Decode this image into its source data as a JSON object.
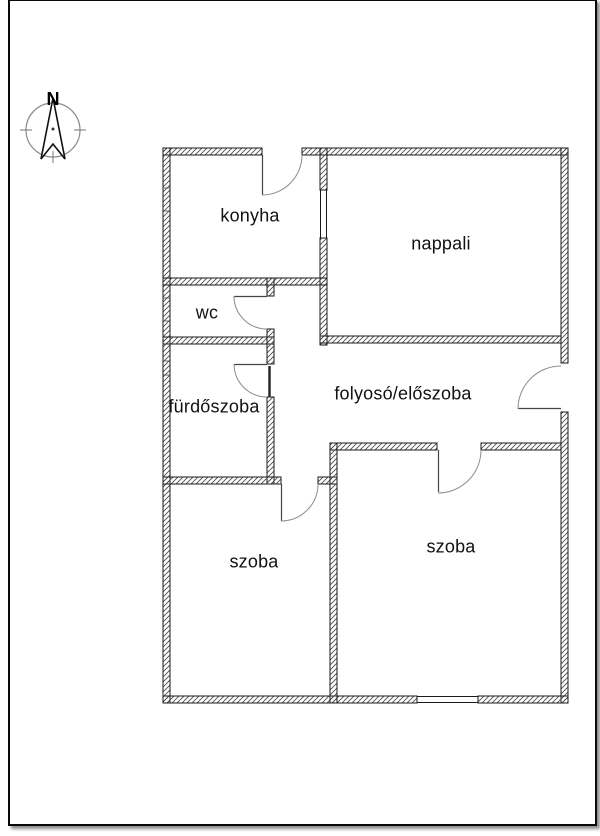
{
  "compass": {
    "north_label": "N"
  },
  "floor_plan": {
    "rooms": [
      {
        "id": "konyha",
        "label": "konyha"
      },
      {
        "id": "nappali",
        "label": "nappali"
      },
      {
        "id": "wc",
        "label": "wc"
      },
      {
        "id": "furdoszoba",
        "label": "fürdőszoba"
      },
      {
        "id": "folyoso",
        "label": "folyosó/előszoba"
      },
      {
        "id": "szoba-left",
        "label": "szoba"
      },
      {
        "id": "szoba-right",
        "label": "szoba"
      }
    ],
    "colors": {
      "wall_line": "#1a1a1a",
      "hatch": "#4d4d4d",
      "door_arc": "#8c8c8c",
      "compass_ring": "#8a8a8a"
    }
  }
}
